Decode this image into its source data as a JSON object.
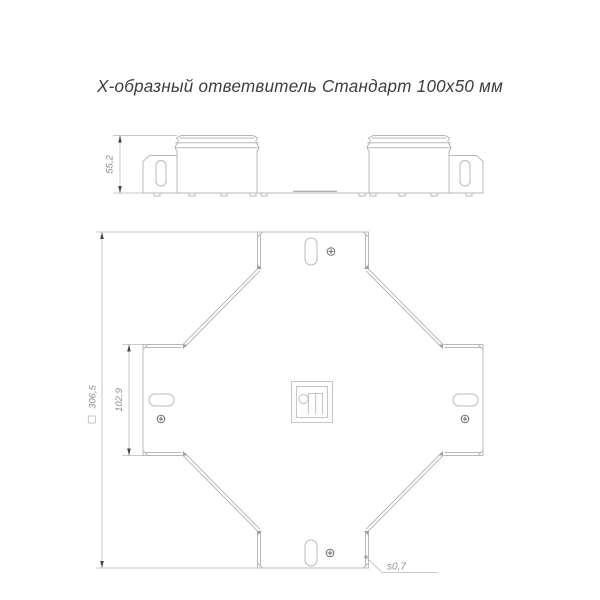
{
  "title": "Х-образный ответвитель Стандарт 100х50 мм",
  "side_view": {
    "height_dim": "55,2"
  },
  "plan_view": {
    "overall_dim": "306,5",
    "overall_dim_prefix": "square-section-symbol",
    "branch_width_dim": "102,9",
    "sheet_thickness_label": "s0,7"
  },
  "logo": {
    "name": "brand-monogram"
  },
  "colors": {
    "drawing_line": "#b8b8b8",
    "dim_line": "#b6b6b6",
    "dim_text": "#8d8d8d",
    "arrow": "#474747",
    "screw": "#6f6f6f",
    "title_text": "#3d3d3d",
    "background": "#ffffff"
  }
}
